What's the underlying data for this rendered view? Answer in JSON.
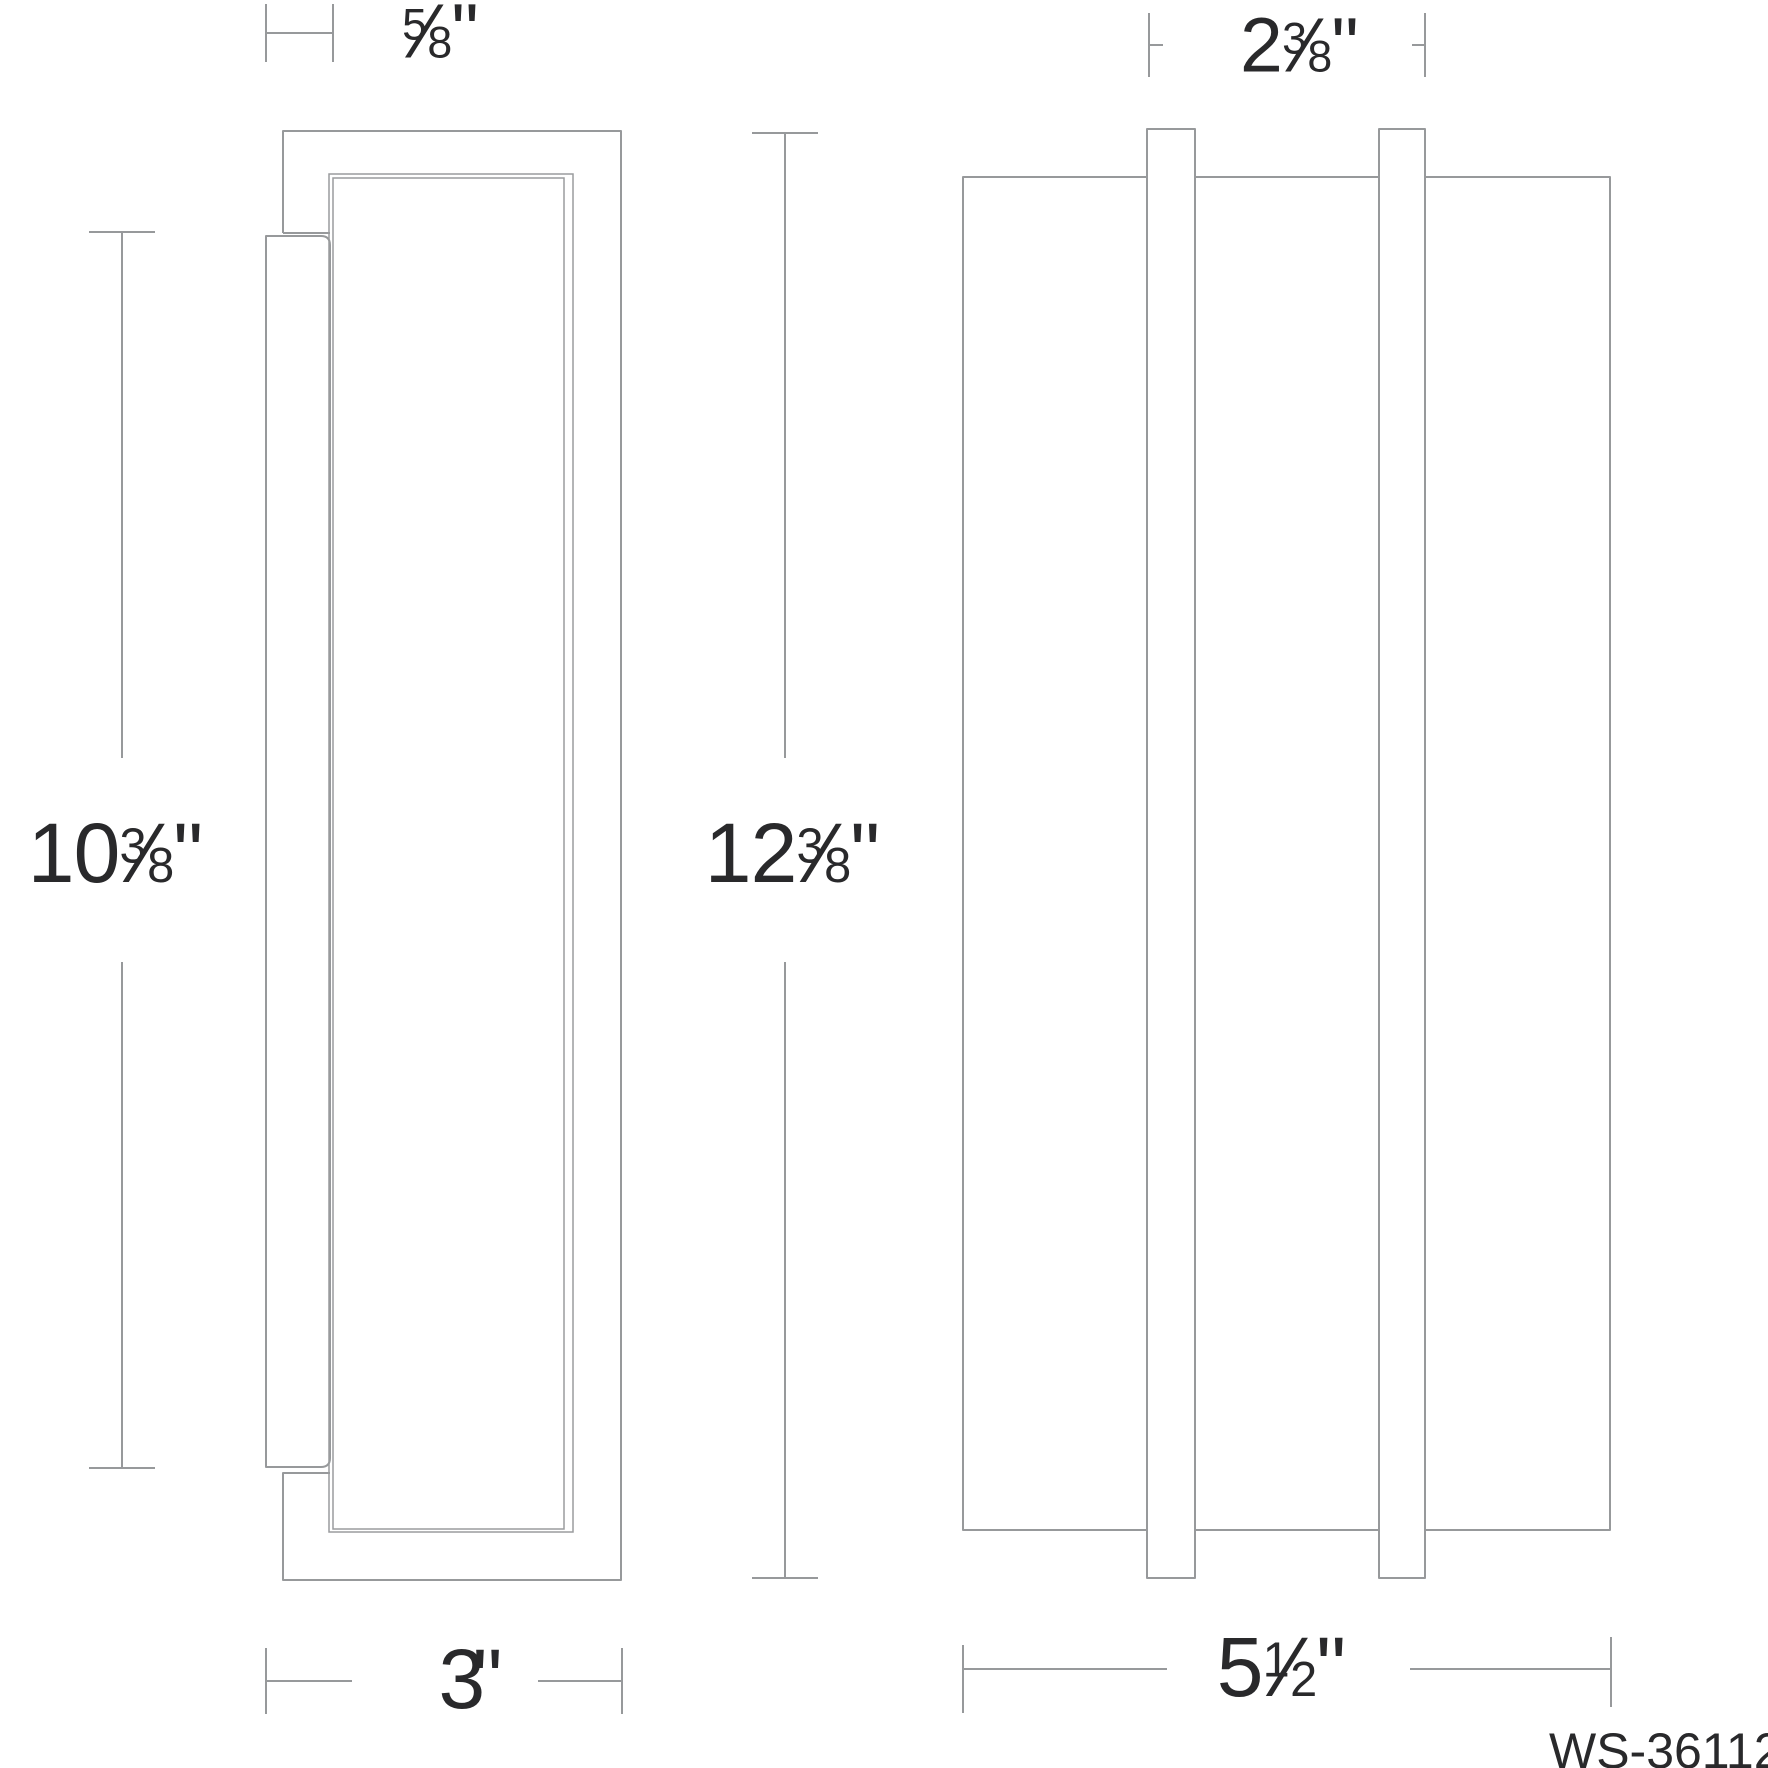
{
  "page": {
    "background_color": "#ffffff",
    "line_color": "#97999b",
    "text_color": "#29292b"
  },
  "drawing": {
    "model_number": "WS-36112",
    "fraction_slash": "⁄"
  },
  "dimensions": [
    {
      "id": "depth-top",
      "whole": "",
      "num": "5",
      "den": "8",
      "slash": "⁄",
      "unit": "\""
    },
    {
      "id": "backplate-height",
      "whole": "10",
      "num": "3",
      "den": "8",
      "slash": "⁄",
      "unit": "\""
    },
    {
      "id": "overall-height",
      "whole": "12",
      "num": "3",
      "den": "8",
      "slash": "⁄",
      "unit": "\""
    },
    {
      "id": "mount-depth",
      "whole": "3",
      "num": "",
      "den": "",
      "slash": "",
      "unit": "\""
    },
    {
      "id": "bar-spacing",
      "whole": "2",
      "num": "3",
      "den": "8",
      "slash": "⁄",
      "unit": "\""
    },
    {
      "id": "overall-width",
      "whole": "5",
      "num": "1",
      "den": "2",
      "slash": "⁄",
      "unit": "\""
    }
  ]
}
